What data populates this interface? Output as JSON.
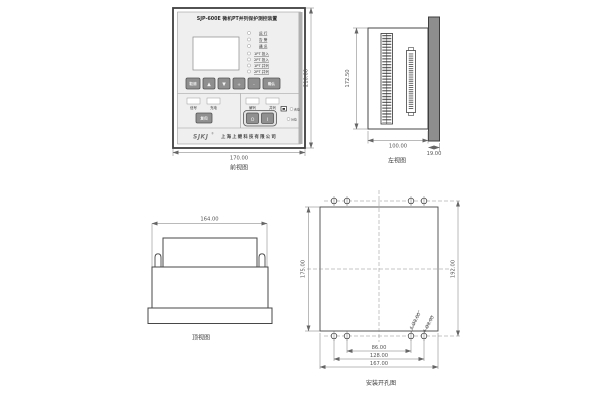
{
  "drawing": {
    "front": {
      "caption": "前视图",
      "dim_width": "170.00",
      "dim_height": "210.00",
      "title": "SJP-600E  微机PT并列保护测控装置",
      "leds_status": [
        "运 行",
        "告 警",
        "通 讯"
      ],
      "leds_pt": [
        "1PT 投入",
        "2PT 投入",
        "1PT 并列",
        "2PT 并列"
      ],
      "keys": [
        "取消",
        "▲",
        "▼",
        "+",
        "-",
        "确认"
      ],
      "left_panel": {
        "win1": "信号",
        "win2": "充电",
        "reset_btn": "复归"
      },
      "right_panel": {
        "win1": "解列",
        "win2": "并列",
        "btn_off": "O",
        "btn_on": "I",
        "led1": "合位",
        "led2": "分位"
      },
      "brand": "SJKJ",
      "brand_reg": "®",
      "company": "上海上继科技有限公司"
    },
    "left_side": {
      "caption": "左视图",
      "dim_height": "172.50",
      "dim_depth": "100.00",
      "dim_panel": "19.00"
    },
    "top": {
      "caption": "顶视图",
      "dim_width": "164.00"
    },
    "drill": {
      "caption": "安装开孔图",
      "dim_left": "175.00",
      "dim_right": "192.00",
      "dim_inner": "86.00",
      "dim_mid": "128.00",
      "dim_outer": "167.00",
      "hole_note_a": "4-Ø8.00",
      "hole_note_b": "4-Ø8.00"
    }
  }
}
